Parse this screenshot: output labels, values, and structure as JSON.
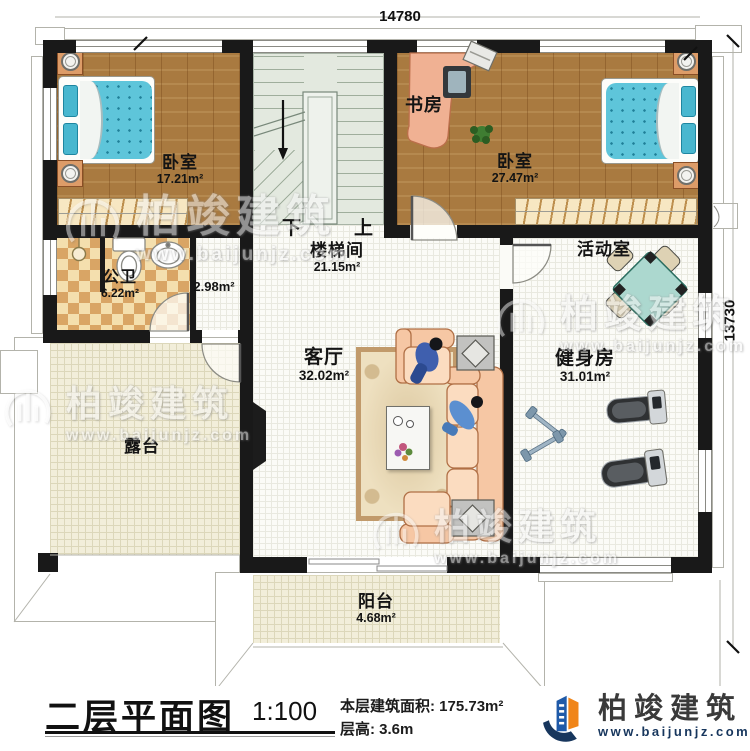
{
  "dimensions": {
    "width_mm": "14780",
    "height_mm": "13730"
  },
  "rooms": {
    "bedroom_left": {
      "name": "卧室",
      "area": "17.21m²"
    },
    "study": {
      "name": "书房"
    },
    "bedroom_right": {
      "name": "卧室",
      "area": "27.47m²"
    },
    "bathroom": {
      "name": "公卫",
      "area": "6.22m²"
    },
    "closet": {
      "area": "2.98m²"
    },
    "stairwell": {
      "name": "楼梯间",
      "area": "21.15m²"
    },
    "activity": {
      "name": "活动室"
    },
    "living": {
      "name": "客厅",
      "area": "32.02m²"
    },
    "gym": {
      "name": "健身房",
      "area": "31.01m²"
    },
    "terrace": {
      "name": "露台"
    },
    "balcony": {
      "name": "阳台",
      "area": "4.68m²"
    }
  },
  "stairs": {
    "down": "下",
    "up": "上"
  },
  "footer": {
    "title": "二层平面图",
    "scale": "1:100",
    "area_label": "本层建筑面积:",
    "area_value": "175.73m²",
    "floor_height_label": "层高:",
    "floor_height_value": "3.6m"
  },
  "brand": {
    "name": "柏竣建筑",
    "url": "www.baijunjz.com"
  },
  "colors": {
    "wall": "#191919",
    "wood_floor": "#a97a40",
    "stair_floor": "#e3e9df",
    "checker_tile": "#d9a565",
    "outdoor_tile": "#f2eeda",
    "bed_blue": "#5ec5da",
    "sofa_salmon": "#f6c7a4",
    "table_teal": "#acd8cf",
    "brand_blue": "#1f5aa8",
    "brand_orange": "#f08519",
    "brand_navy": "#17365d"
  }
}
